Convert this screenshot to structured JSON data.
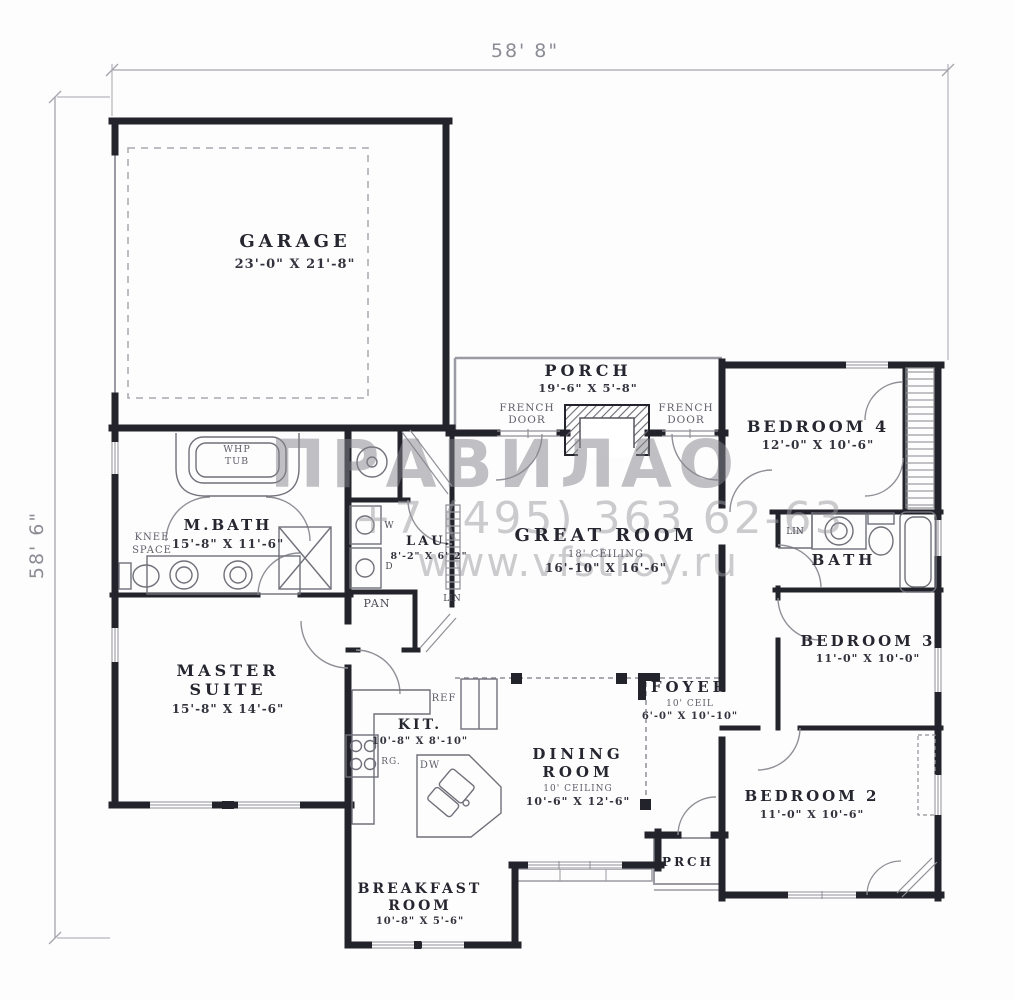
{
  "dimensions": {
    "top": "58' 8\"",
    "left": "58' 6\""
  },
  "watermark": {
    "logo": "ПРАВИЛАО",
    "phone": "+7 (495) 363 62-63",
    "website": "www.vfstroy.ru"
  },
  "rooms": {
    "garage": {
      "name": "GARAGE",
      "size": "23'-0\" X 21'-8\""
    },
    "porch": {
      "name": "PORCH",
      "size": "19'-6\" X 5'-8\""
    },
    "great_room": {
      "name": "GREAT ROOM",
      "ceiling": "18' CEILING",
      "size": "16'-10\" X 16'-6\""
    },
    "master_bath": {
      "name": "M.BATH",
      "size": "15'-8\" X 11'-6\""
    },
    "laundry": {
      "name": "LAU.",
      "size": "8'-2\" X 6'-2\""
    },
    "master_suite": {
      "line1": "MASTER",
      "line2": "SUITE",
      "size": "15'-8\" X 14'-6\""
    },
    "kitchen": {
      "name": "KIT.",
      "size": "10'-8\" X 8'-10\""
    },
    "dining": {
      "line1": "DINING",
      "line2": "ROOM",
      "ceiling": "10' CEILING",
      "size": "10'-6\" X 12'-6\""
    },
    "foyer": {
      "name": "FOYER",
      "ceiling": "10' CEIL",
      "size": "6'-0\" X 10'-10\""
    },
    "breakfast": {
      "line1": "BREAKFAST",
      "line2": "ROOM",
      "size": "10'-8\" X 5'-6\""
    },
    "bedroom2": {
      "name": "BEDROOM 2",
      "size": "11'-0\" X 10'-6\""
    },
    "bedroom3": {
      "name": "BEDROOM 3",
      "size": "11'-0\" X 10'-0\""
    },
    "bedroom4": {
      "name": "BEDROOM 4",
      "size": "12'-0\" X 10'-6\""
    },
    "bath": {
      "name": "BATH"
    },
    "front_porch": {
      "name": "PRCH"
    }
  },
  "labels": {
    "french_door_line1": "FRENCH",
    "french_door_line2": "DOOR",
    "whp_line1": "WHP",
    "whp_line2": "TUB",
    "knee_line1": "KNEE",
    "knee_line2": "SPACE",
    "pan": "PAN",
    "lin": "LIN",
    "washer": "W",
    "dryer": "D",
    "ref": "REF",
    "range": "RG.",
    "dishwasher": "DW"
  }
}
